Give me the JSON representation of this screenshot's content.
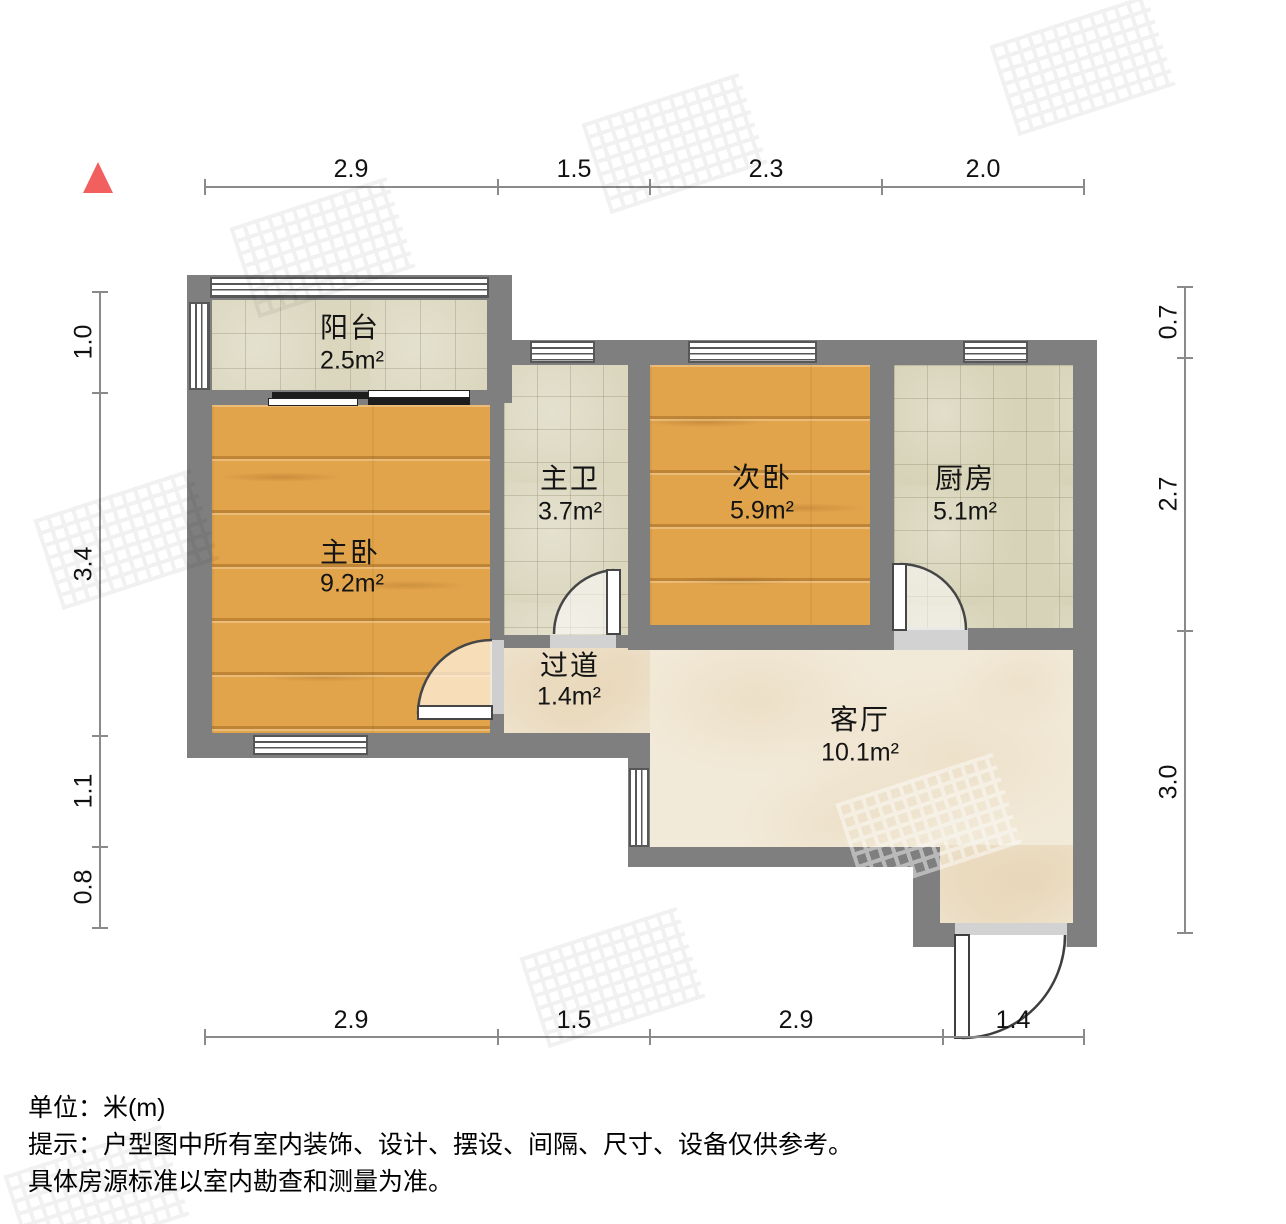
{
  "rooms": {
    "balcony": {
      "name": "阳台",
      "area": "2.5m²"
    },
    "master_bedroom": {
      "name": "主卧",
      "area": "9.2m²"
    },
    "master_bath": {
      "name": "主卫",
      "area": "3.7m²"
    },
    "second_bedroom": {
      "name": "次卧",
      "area": "5.9m²"
    },
    "kitchen": {
      "name": "厨房",
      "area": "5.1m²"
    },
    "hallway": {
      "name": "过道",
      "area": "1.4m²"
    },
    "living_room": {
      "name": "客厅",
      "area": "10.1m²"
    }
  },
  "dimensions": {
    "top": [
      "2.9",
      "1.5",
      "2.3",
      "2.0"
    ],
    "bottom": [
      "2.9",
      "1.5",
      "2.9",
      "1.4"
    ],
    "left": [
      "1.0",
      "3.4",
      "1.1",
      "0.8"
    ],
    "right": [
      "0.7",
      "2.7",
      "3.0"
    ]
  },
  "footer": {
    "line1": "单位：米(m)",
    "line2": "提示：户型图中所有室内装饰、设计、摆设、间隔、尺寸、设备仅供参考。",
    "line3": "具体房源标准以室内勘查和测量为准。"
  },
  "colors": {
    "wall": "#7f7f7f",
    "wood_floor": "#e2a44b",
    "tile_floor": "#dbd7bf",
    "marble_floor": "#f2ead9",
    "north_arrow": "#f15f5f",
    "dimension_line": "#8a8a8a"
  }
}
